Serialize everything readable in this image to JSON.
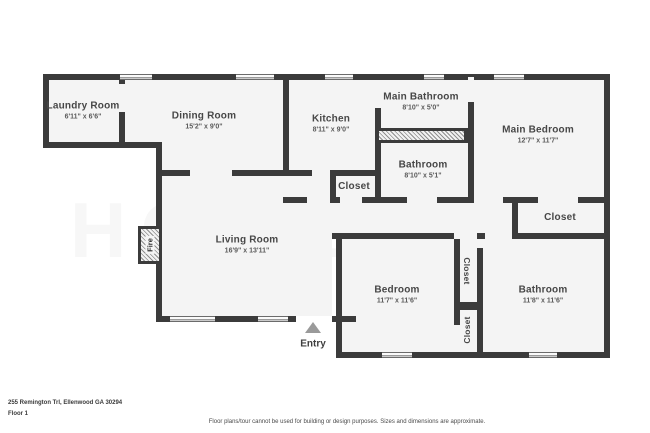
{
  "address": "255 Remington Trl, Ellenwood GA 30294",
  "floor_label": "Floor 1",
  "disclaimer": "Floor plans/tour cannot be used for building or design purposes. Sizes and dimensions are approximate.",
  "watermark": "HOMES",
  "entry_label": "Entry",
  "fire_label": "Fire",
  "colors": {
    "wall": "#3b3b3b",
    "room_fill": "#f4f4f4",
    "label_text": "#474747",
    "dim_text": "#5a5a5a",
    "entry_arrow": "#9a9a9a"
  },
  "rooms": [
    {
      "name": "Laundry Room",
      "dims": "6'11\" x 6'6\""
    },
    {
      "name": "Dining Room",
      "dims": "15'2\" x 9'0\""
    },
    {
      "name": "Kitchen",
      "dims": "8'11\" x 9'0\""
    },
    {
      "name": "Main Bathroom",
      "dims": "8'10\" x 5'0\""
    },
    {
      "name": "Bathroom",
      "dims": "8'10\" x 5'1\""
    },
    {
      "name": "Main Bedroom",
      "dims": "12'7\" x 11'7\""
    },
    {
      "name": "Closet",
      "dims": ""
    },
    {
      "name": "Closet",
      "dims": ""
    },
    {
      "name": "Living Room",
      "dims": "16'9\" x 13'11\""
    },
    {
      "name": "Bedroom",
      "dims": "11'7\" x 11'6\""
    },
    {
      "name": "Closet",
      "dims": ""
    },
    {
      "name": "Closet",
      "dims": ""
    },
    {
      "name": "Bathroom",
      "dims": "11'8\" x 11'6\""
    }
  ]
}
